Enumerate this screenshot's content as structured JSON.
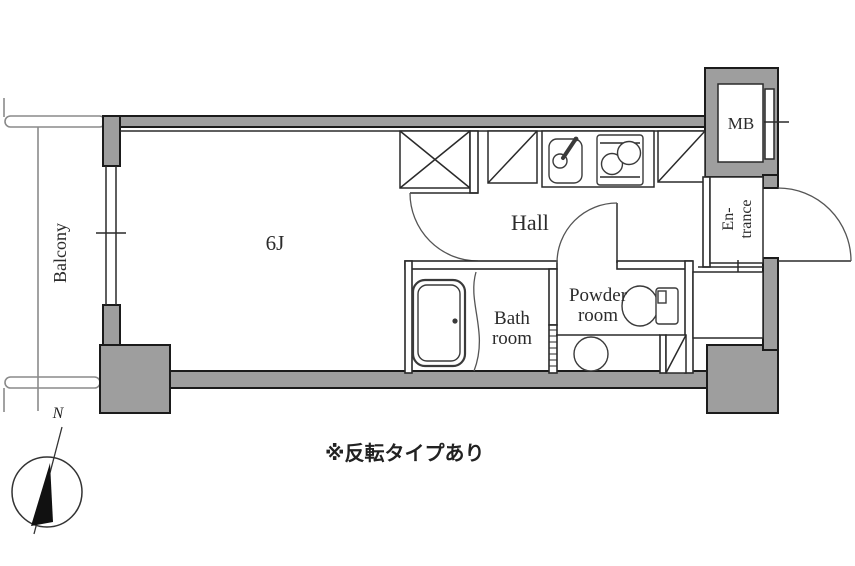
{
  "plan": {
    "labels": {
      "balcony": "Balcony",
      "main_room": "6J",
      "hall": "Hall",
      "bath_line1": "Bath",
      "bath_line2": "room",
      "powder_line1": "Powder",
      "powder_line2": "room",
      "entrance_line1": "En-",
      "entrance_line2": "trance",
      "meter_box": "MB",
      "north": "N",
      "note": "※反転タイプあり"
    },
    "colors": {
      "wall_fill": "#9e9e9e",
      "wall_stroke": "#1b1b1b",
      "line": "#2a2a2a",
      "background": "#ffffff"
    }
  }
}
